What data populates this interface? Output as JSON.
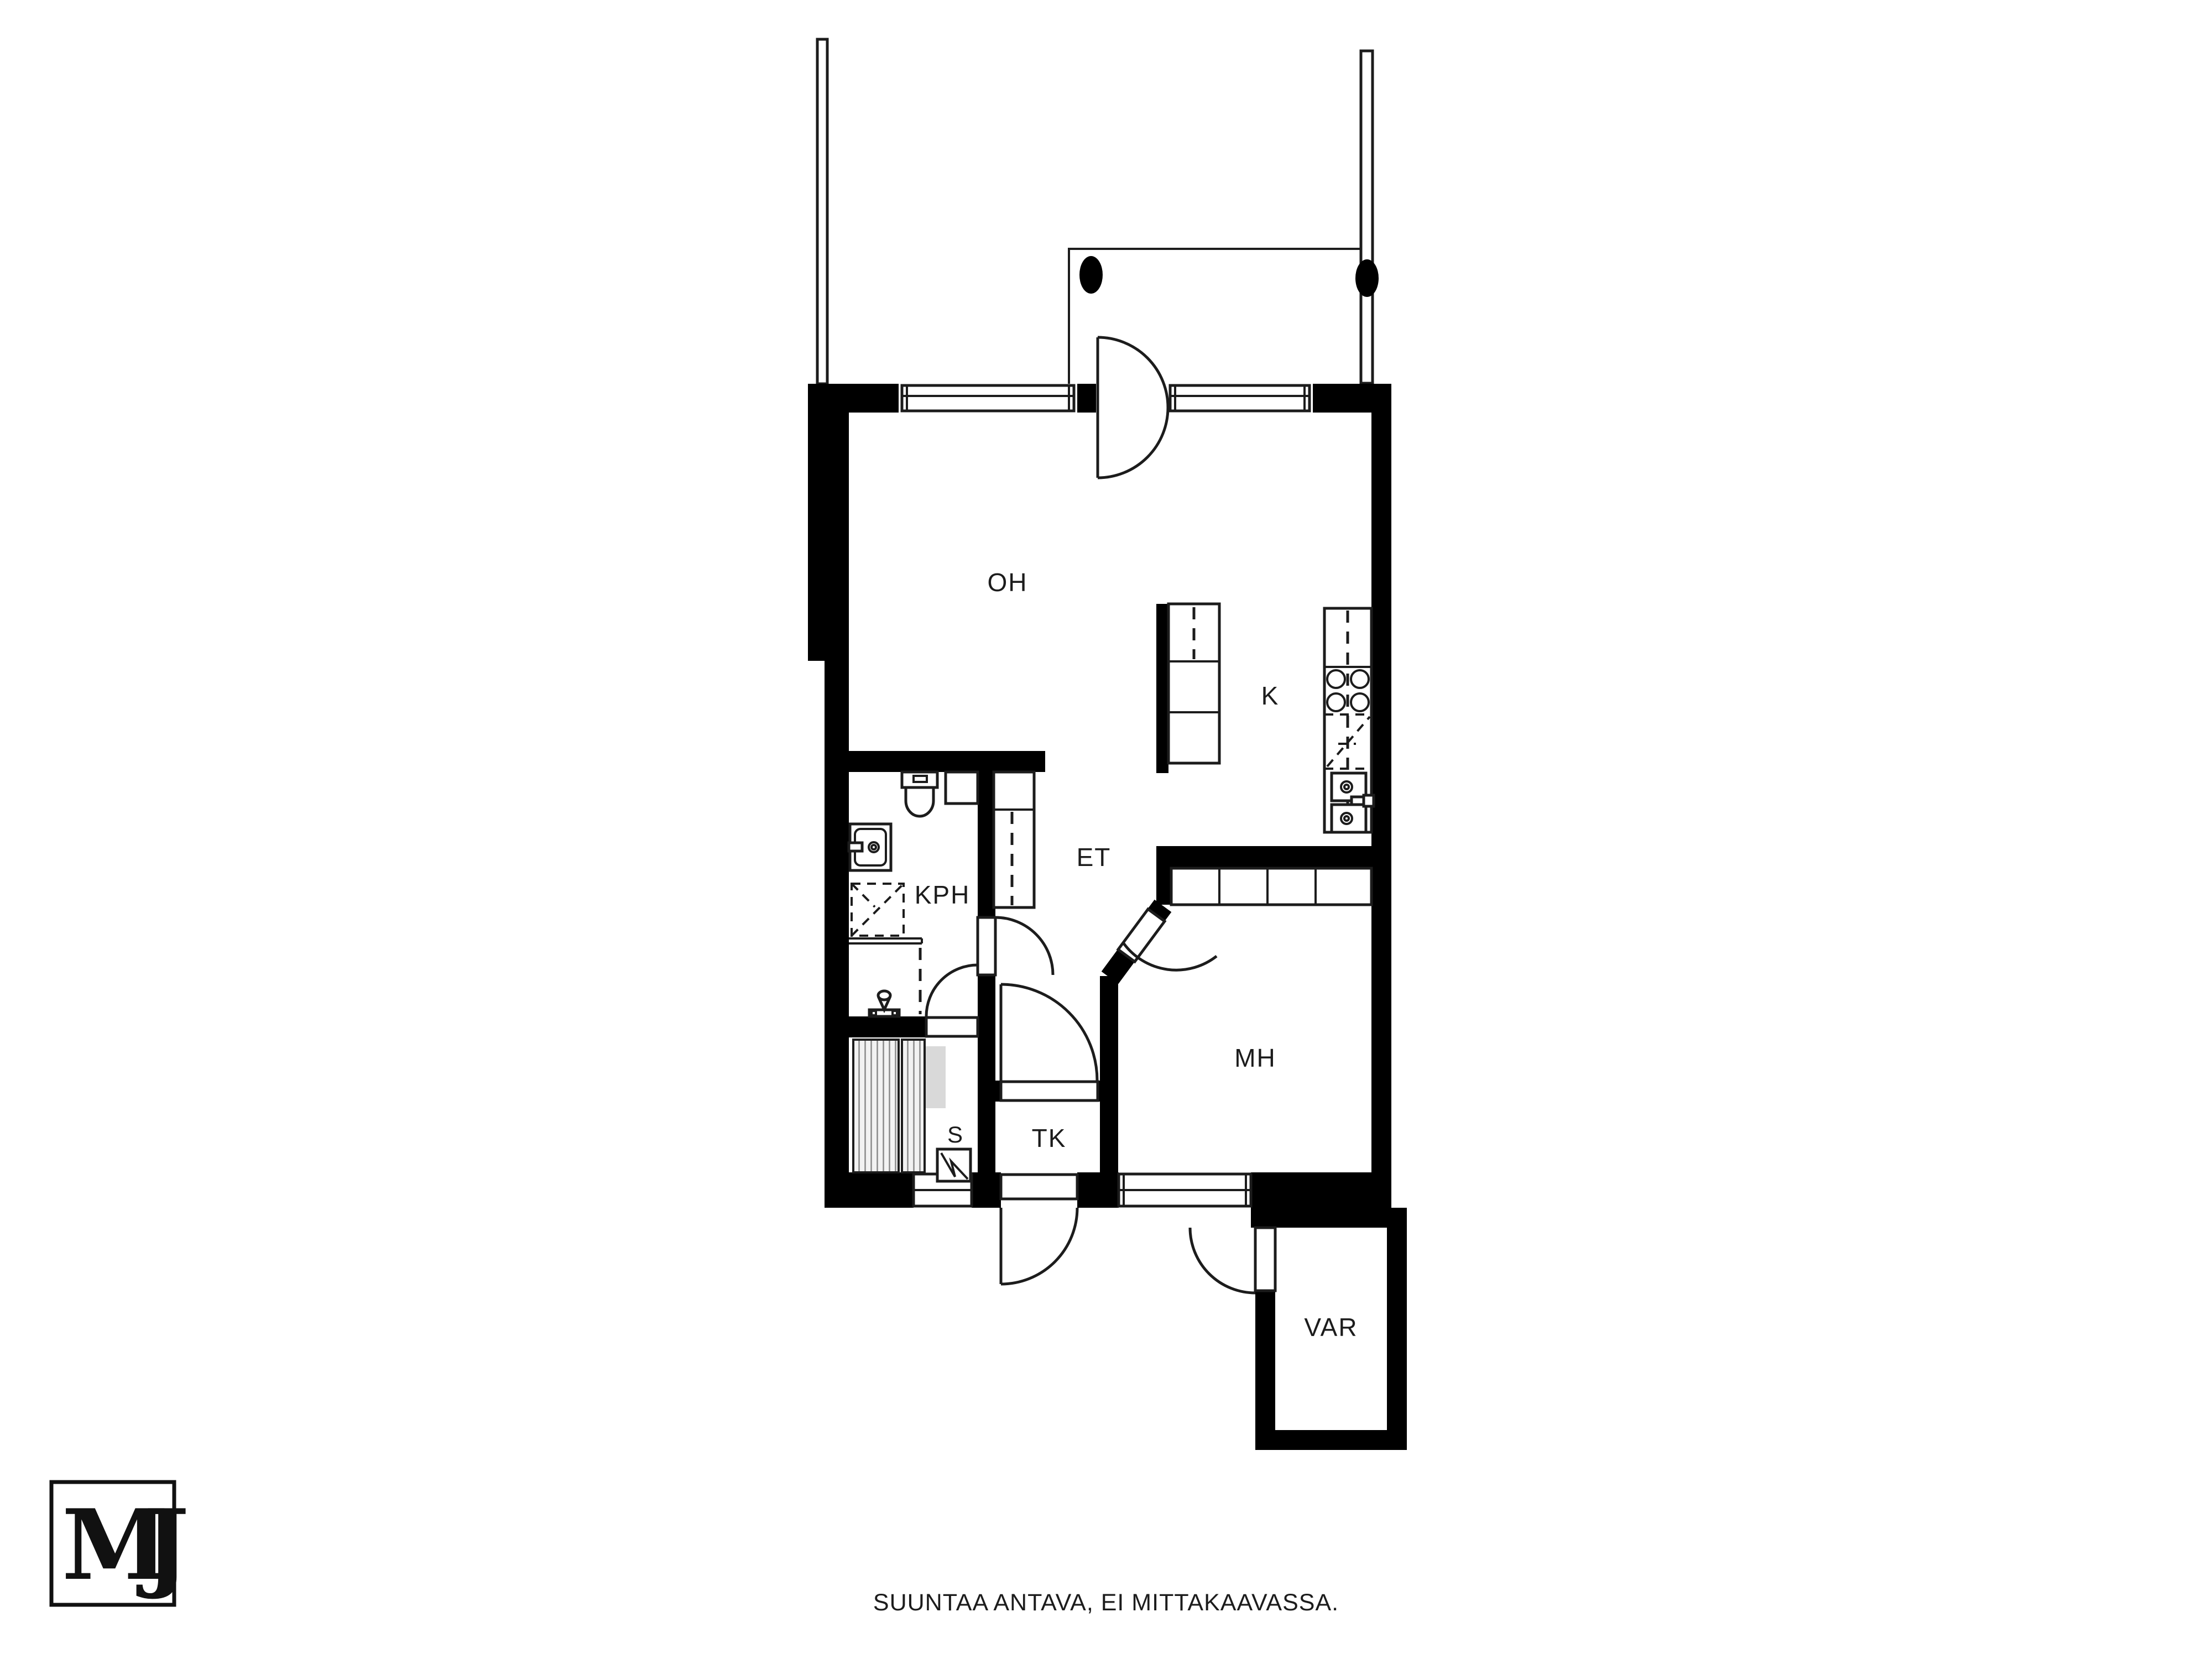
{
  "floorplan": {
    "rooms": [
      {
        "id": "oh",
        "name": "living-room",
        "label": "OH"
      },
      {
        "id": "k",
        "name": "kitchen",
        "label": "K"
      },
      {
        "id": "kph",
        "name": "bathroom",
        "label": "KPH"
      },
      {
        "id": "et",
        "name": "hallway",
        "label": "ET"
      },
      {
        "id": "mh",
        "name": "bedroom",
        "label": "MH"
      },
      {
        "id": "s",
        "name": "sauna",
        "label": "S"
      },
      {
        "id": "tk",
        "name": "vestibule",
        "label": "TK"
      },
      {
        "id": "var",
        "name": "storage",
        "label": "VAR"
      }
    ],
    "colors": {
      "wall": "#000000",
      "background": "#ffffff",
      "line": "#1c1c1c",
      "bench_fill": "#d9d9d9"
    }
  },
  "logo": {
    "text": "MJ"
  },
  "footer": {
    "disclaimer": "SUUNTAA ANTAVA, EI MITTAKAAVASSA."
  }
}
